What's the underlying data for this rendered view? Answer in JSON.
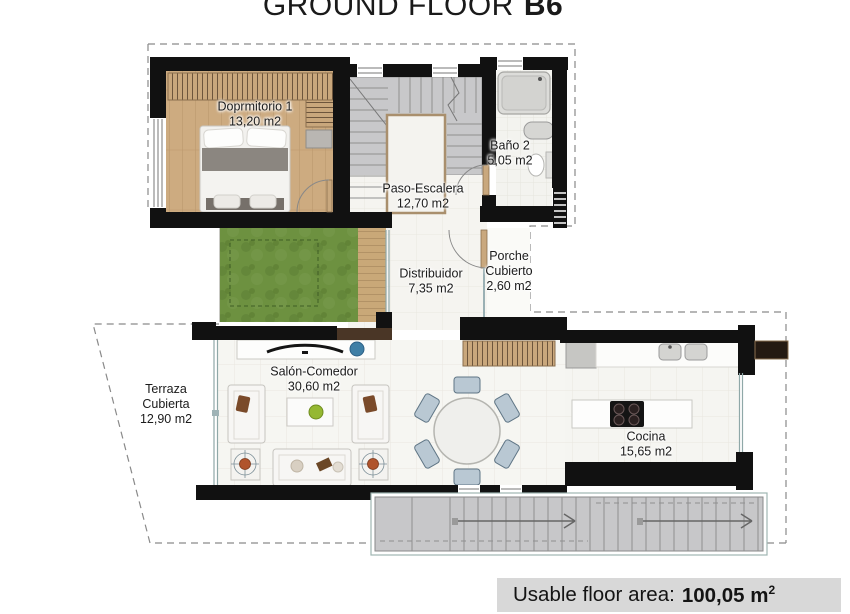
{
  "title": {
    "main": "GROUND FLOOR",
    "unit": "B6"
  },
  "rooms": {
    "dormitorio": {
      "name": "Doprmitorio 1",
      "area": "13,20 m2"
    },
    "bano": {
      "name": "Baño 2",
      "area": "5,05 m2"
    },
    "paso_escalera": {
      "name": "Paso-Escalera",
      "area": "12,70 m2"
    },
    "distribuidor": {
      "name": "Distribuidor",
      "area": "7,35 m2"
    },
    "porche": {
      "line1": "Porche",
      "line2": "Cubierto",
      "area": "2,60 m2"
    },
    "terraza": {
      "line1": "Terraza",
      "line2": "Cubierta",
      "area": "12,90 m2"
    },
    "salon": {
      "name": "Salón-Comedor",
      "area": "30,60 m2"
    },
    "cocina": {
      "name": "Cocina",
      "area": "15,65 m2"
    }
  },
  "footer": {
    "label": "Usable floor area:",
    "value": "100,05 m",
    "sup": "2"
  },
  "colors": {
    "wall": "#111111",
    "wood_floor": "#cdab80",
    "grass": "#6d9140",
    "stair_tile": "#c8c8ca",
    "dining_chair": "#b9c8d3",
    "decor_blue": "#3f7fa6",
    "decor_green": "#95b832",
    "plant_orange": "#b0542c",
    "footer_bg": "#d8d8d8"
  }
}
